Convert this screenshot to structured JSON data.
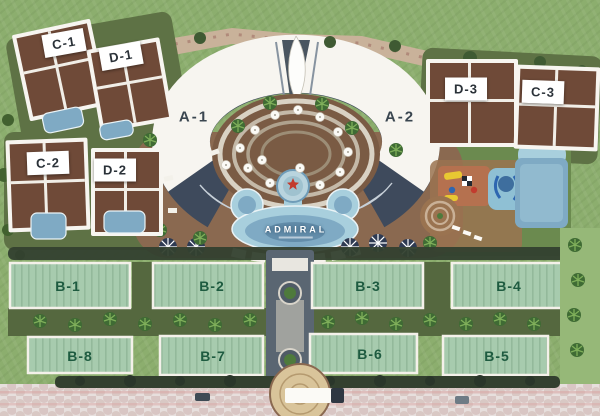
{
  "site_plan": {
    "type": "resort-master-plan-aerial",
    "branding": {
      "pool_logo_text": "ADMIRAL"
    },
    "labels": {
      "a1": "A-1",
      "a2": "A-2",
      "b1": "B-1",
      "b2": "B-2",
      "b3": "B-3",
      "b4": "B-4",
      "b5": "B-5",
      "b6": "B-6",
      "b7": "B-7",
      "b8": "B-8",
      "c1": "C-1",
      "c2": "C-2",
      "c3": "C-3",
      "d1": "D-1",
      "d2": "D-2",
      "d3": "D-3"
    },
    "features": [
      "crescent-main-building",
      "sail-tower",
      "terraced-courtyard",
      "main-pool",
      "kids-aquapark",
      "lap-pool",
      "playground",
      "spiral-garden",
      "villa-pools",
      "roundabout-driveway",
      "paved-road"
    ]
  },
  "colors": {
    "grass": "#8CAE6E",
    "wall": "#C9B29A",
    "deck": "#8A6950",
    "garden": "#5E7245",
    "pool-light": "#A8CFDD",
    "pool-mid": "#7FAAC4",
    "pool-deep": "#5E88A6",
    "roof-brown": "#6F4A38",
    "roof-green": "#A7CBAE",
    "white-bldg": "#F7F5F0",
    "hedge": "#33402F",
    "road": "#E7DFDD",
    "road-pink": "#D4AEAC",
    "label-green": "#1E5B40",
    "label-slate": "#3A4650",
    "label-dark": "#2A3138",
    "label-box": "#FFFFFF"
  }
}
